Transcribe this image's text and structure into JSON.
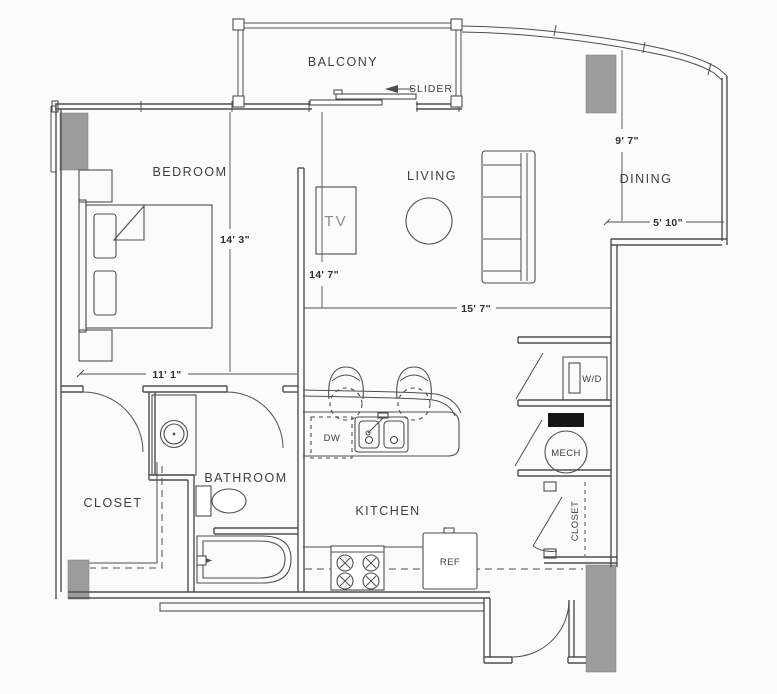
{
  "plan": {
    "rooms": {
      "balcony": "BALCONY",
      "bedroom": "BEDROOM",
      "living": "LIVING",
      "dining": "DINING",
      "kitchen": "KITCHEN",
      "bathroom": "BATHROOM",
      "closet": "CLOSET",
      "entry_closet": "CLOSET"
    },
    "fixtures": {
      "slider": "SLIDER",
      "mech": "MECH",
      "washer_dryer": "W/D",
      "dishwasher": "DW",
      "refrigerator": "REF",
      "tv": "TV"
    },
    "dimensions": {
      "bedroom_length": "14' 3\"",
      "living_length": "14' 7\"",
      "living_width": "15' 7\"",
      "bedroom_width": "11' 1\"",
      "dining_length": "9' 7\"",
      "dining_width": "5' 10\""
    }
  },
  "colors": {
    "bg": "#fbfbfb",
    "line": "#4e4e4e",
    "text": "#3e3e3e",
    "dim_text": "#2f2f2f",
    "column_fill": "#9c9c9c",
    "column_stroke": "#858585",
    "mech_panel": "#161616",
    "tv_text": "#8a8a8a"
  }
}
